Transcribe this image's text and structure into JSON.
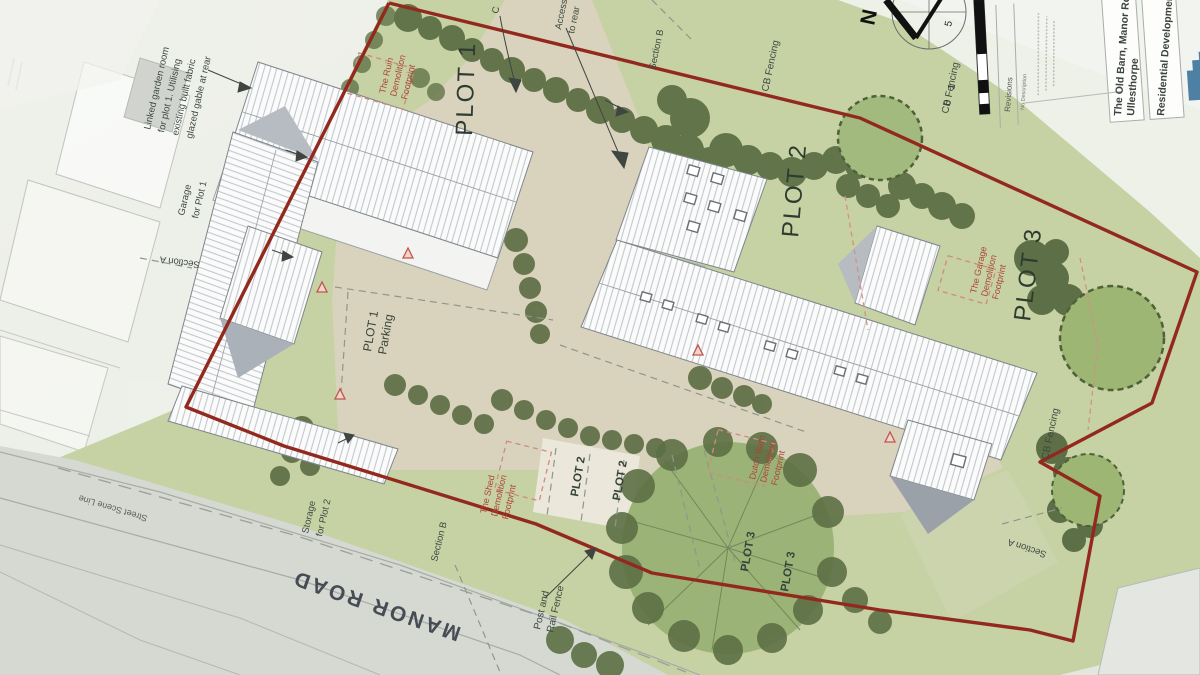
{
  "colors": {
    "site_boundary_red": "#93291e",
    "demolition_text_red": "#ad4537",
    "grass_green": "#c6d1a4",
    "hedge_green": "#5b6d43",
    "driveway_beige": "#d9d3bd",
    "building_white": "#fafbfa",
    "road_grey": "#d6d8d2",
    "logo_blue": "#4e80a3"
  },
  "plan": {
    "plots": {
      "p1": "PLOT 1",
      "p2": "PLOT 2",
      "p3": "PLOT 3"
    },
    "parking": {
      "plot1": [
        "PLOT 1",
        "Parking"
      ],
      "plot2_bays": [
        "PLOT 2",
        "PLOT 2"
      ],
      "plot3_bays": [
        "PLOT 3",
        "PLOT 3"
      ]
    },
    "notes": {
      "linked_garden_room": [
        "Linked garden room",
        "for plot 1. Utilising",
        "existing built fabric",
        "glazed gable at rear"
      ],
      "garage_for_plot1": [
        "Garage",
        "for Plot 1"
      ],
      "storage_for_plot2": [
        "Storage",
        "for Plot 2"
      ],
      "post_and_rail_fence": [
        "Post and",
        "Rail Fence"
      ],
      "access": [
        "Access",
        "to rear"
      ],
      "close": "C"
    },
    "demolition": {
      "ruin": [
        "The Ruin",
        "Demolition",
        "Footprint"
      ],
      "garage": [
        "The Garage",
        "Demolition",
        "Footprint"
      ],
      "shed": [
        "The Shed",
        "Demolition",
        "Footprint"
      ],
      "dutch_barn": [
        "Dutch Barn",
        "Demolition",
        "Footprint"
      ]
    },
    "streets": {
      "manor_road": "MANOR ROAD",
      "street_scene_line": "Street Scene Line"
    },
    "sections": {
      "a": "Section A",
      "b": "Section B"
    },
    "fencing": {
      "cb": "CB Fencing"
    }
  },
  "titleblock": {
    "revisions_title": "Revisions",
    "revisions_columns": "No Description",
    "project_name": "The Old Barn, Manor Road",
    "project_location": "Ullesthorpe",
    "drawing_title": "Residential Development"
  },
  "compass": {
    "north": "N"
  },
  "scalebar": {
    "zero": "0",
    "one": "1",
    "five": "5"
  }
}
